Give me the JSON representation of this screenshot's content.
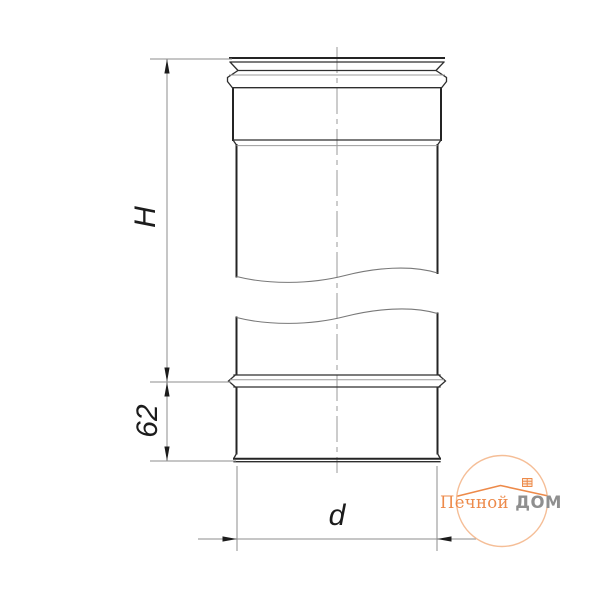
{
  "drawing": {
    "dimension_labels": {
      "height": "H",
      "socket": "62",
      "diameter": "d"
    },
    "line_colors": {
      "outline": "#242424",
      "thin_lines": "#8D8D8D",
      "centerline": "#9A9A9A"
    }
  },
  "logo": {
    "text_primary": "Печной",
    "text_secondary": "ДОМ",
    "colors": {
      "accent": "#ED8A4A",
      "secondary": "#8F8F8F",
      "ring": "#F5BE97"
    }
  }
}
